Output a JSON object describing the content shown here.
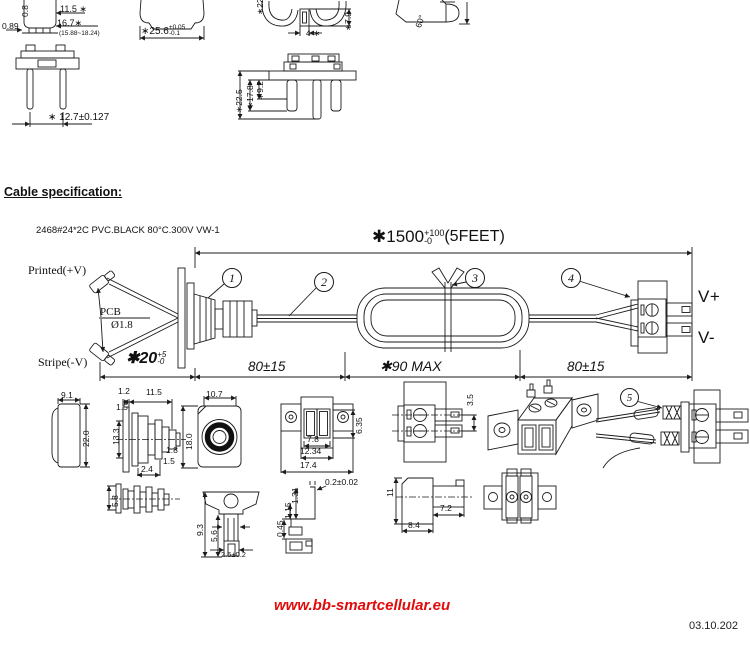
{
  "header": {
    "title": "Cable specification:",
    "spec": "2468#24*2C PVC.BLACK 80°C.300V VW-1"
  },
  "main": {
    "len": "✱1500",
    "len_up": "+100",
    "len_dn": "-0",
    "len_feet": "(5FEET)",
    "printed": "Printed(+V)",
    "pcb": "PCB",
    "pcb_dia": "Ø1.8",
    "stripe": "Stripe(-V)",
    "vplus": "V+",
    "vminus": "V-",
    "d20": "✱20",
    "d20_up": "+5",
    "d20_dn": "-0",
    "seg_a": "80±15",
    "seg_b": "✱90 MAX",
    "seg_c": "80±15",
    "b1": "1",
    "b2": "2",
    "b3": "3",
    "b4": "4",
    "b5": "5"
  },
  "top_views": {
    "d08": "0.8",
    "d115": "11.5 ∗",
    "d167": "16.7∗",
    "range": "(15.88~18.24)",
    "d089": "0.89",
    "d127": "∗ 12.7±0.127",
    "d256": "∗25.6",
    "d256_up": "+0.05",
    "d256_dn": "-0.1",
    "d22": "∗22",
    "d79": "∗7.9",
    "d4": "4 ∗",
    "d225": "∗22.5",
    "d178": "∗17.8",
    "d92": "∗9.2",
    "d60": "60°"
  },
  "details": {
    "d91": "9.1",
    "d220": "22.0",
    "d12": "1.2",
    "d115": "11.5",
    "d15a": "1.5",
    "d133": "13.3",
    "d180": "18.0",
    "d18": "1.8",
    "d15b": "1.5",
    "d24": "2.4",
    "d107": "10.7",
    "d58": "5.8",
    "d93": "9.3",
    "d56": "5.6",
    "d25": "2.5±0.2",
    "d78": "7.8",
    "d1234": "12.34",
    "d174": "17.4",
    "d635": "6.35",
    "d35": "3.5",
    "d02": "0.2±0.02",
    "d045": "0.45",
    "d1_15": "1.15",
    "d131": "1.31",
    "d11": "11",
    "d72": "7.2",
    "d84": "8.4"
  },
  "footer": {
    "url": "www.bb-smartcellular.eu",
    "date": "03.10.202"
  },
  "colors": {
    "line": "#1b1b1b",
    "red": "#e20a0a"
  }
}
